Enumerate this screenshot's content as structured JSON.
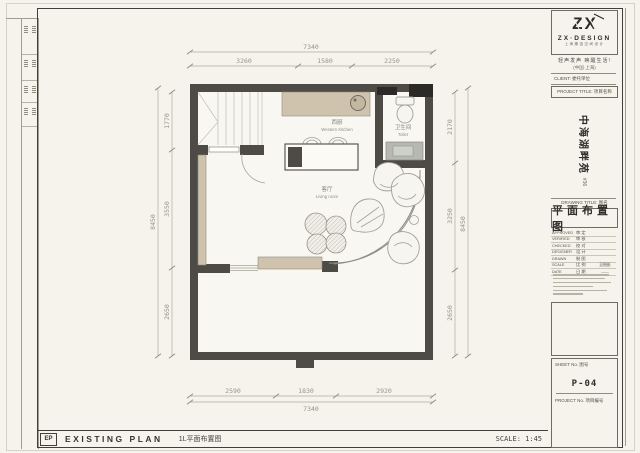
{
  "title_block": {
    "brand": {
      "logo": "ZX",
      "name": "ZX·DESIGN",
      "name_cn": "上海臻选空间设计",
      "slogan": "轻声发声  唤醒生活!",
      "location": "(中国·上海)"
    },
    "client_label": "CLIENT: 委托单位",
    "project_title_label": "PROJECT TITLE: 项目名称",
    "project_name": "中海湖畔苑",
    "project_name_note": "#36",
    "drawing_title_label": "DRAWING TITLE: 图名",
    "drawing_title": "平面布置图",
    "sign_rows": [
      {
        "en": "APPROVED",
        "cn": "审 定",
        "value": ""
      },
      {
        "en": "VERIFIED",
        "cn": "审 核",
        "value": ""
      },
      {
        "en": "CHECKED",
        "cn": "校 对",
        "value": ""
      },
      {
        "en": "DESIGNER",
        "cn": "设 计",
        "value": ""
      },
      {
        "en": "DRAWN",
        "cn": "制 图",
        "value": ""
      },
      {
        "en": "SCALE",
        "cn": "比 例",
        "value": "见图纸"
      },
      {
        "en": "DATE",
        "cn": "日 期",
        "value": "——"
      }
    ],
    "sheet_label": "SHEET No. 图号",
    "sheet_no": "P-04",
    "project_no_label": "PROJECT No. 项目编号"
  },
  "footer": {
    "code": "EP",
    "title_en": "EXISTING PLAN",
    "title_cn": "1L平面布置图",
    "scale": "SCALE: 1:45"
  },
  "plan": {
    "rooms": [
      {
        "cn": "西厨",
        "en": "Western Kitchen"
      },
      {
        "cn": "卫生间",
        "en": "Toilet"
      },
      {
        "cn": "客厅",
        "en": "Living room"
      }
    ],
    "dims": {
      "top": {
        "overall": "7340",
        "segments": [
          "3260",
          "1580",
          "2250"
        ]
      },
      "bottom": {
        "overall": "7340",
        "segments": [
          "2590",
          "1830",
          "2920"
        ]
      },
      "left": {
        "overall": "8450",
        "segments": [
          "1770",
          "3550",
          "2650"
        ]
      },
      "right": {
        "overall": "8450",
        "segments": [
          "2170",
          "3250",
          "2650"
        ]
      }
    },
    "colors": {
      "wall": "#4e4b46",
      "accent_black": "#2b2a26",
      "wood": "#cfc3ae",
      "fixture_gray": "#b6b9b1",
      "dim_gray": "#98958a",
      "paper": "#f5f3ec"
    }
  }
}
